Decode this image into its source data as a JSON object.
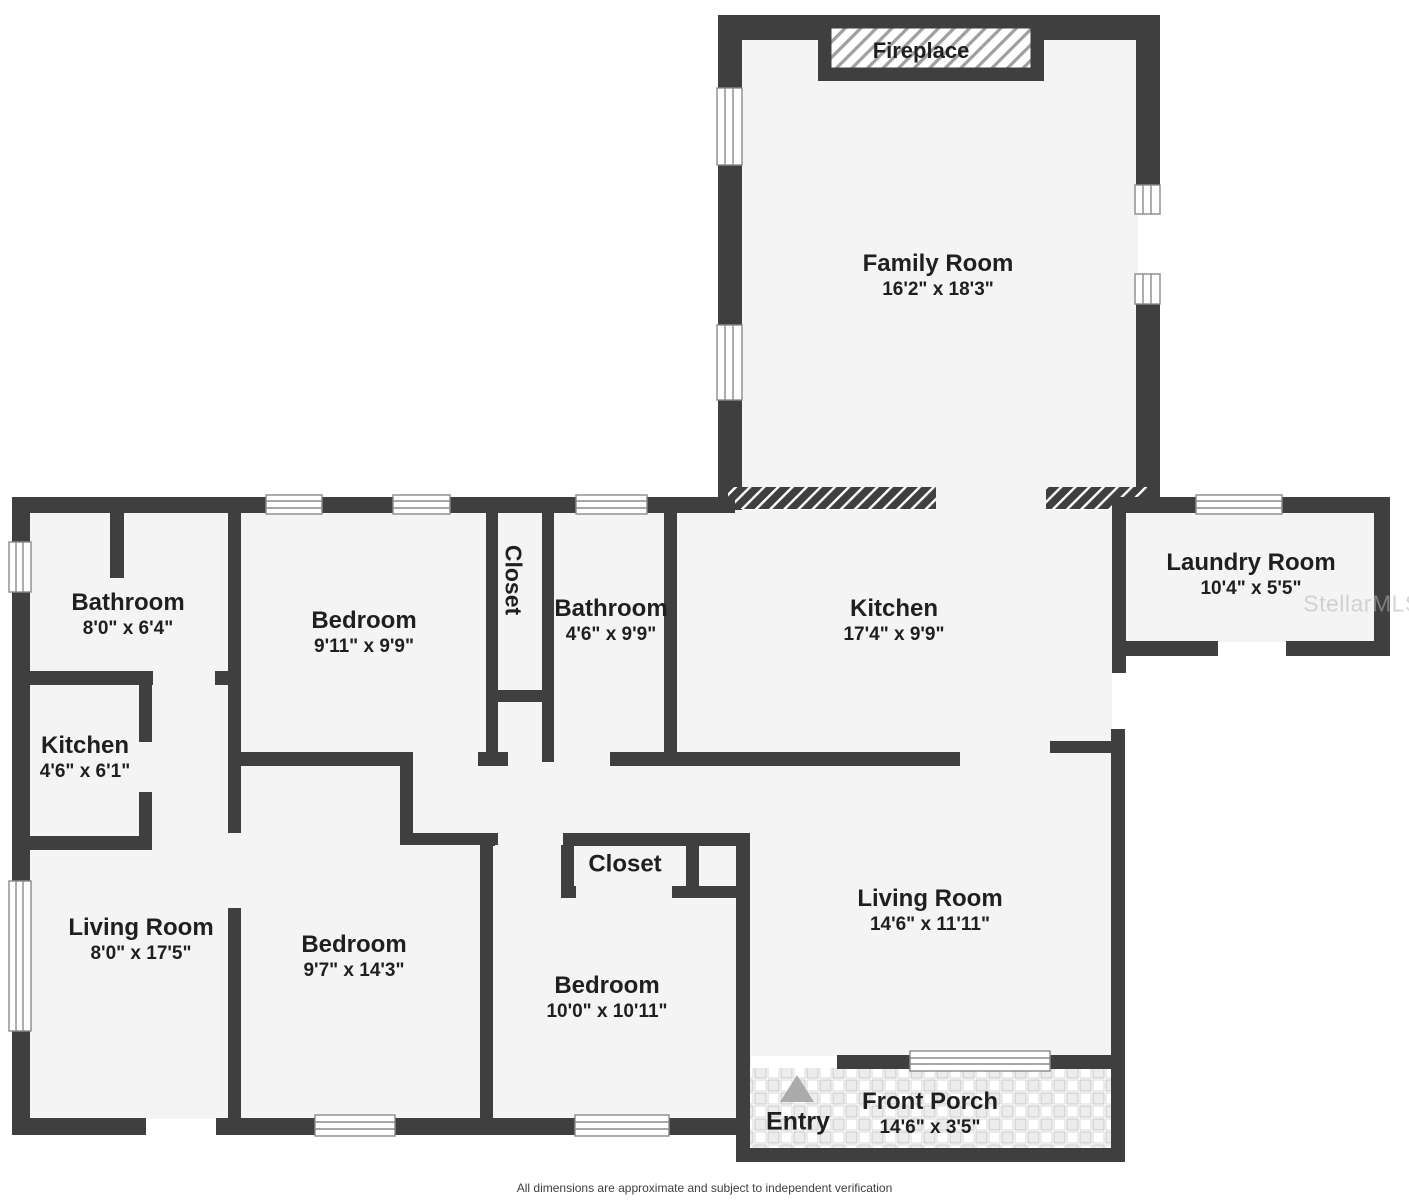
{
  "plan": {
    "footer": "All dimensions are approximate and subject to independent verification",
    "watermark": "StellarMLS",
    "labels": {
      "fireplace": "Fireplace",
      "entry": "Entry"
    },
    "colors": {
      "wall": "#3f3f3f",
      "floor": "#f4f4f4",
      "background": "#ffffff",
      "fireplace_hatch_line": "#9f9f9f",
      "porch_tile": "#ececec",
      "entry_arrow": "#ababab",
      "label_text": "#1f1f1f",
      "footer_text": "#3f3f3f",
      "watermark_text": "#b5b5b5"
    }
  },
  "rooms": [
    {
      "id": "family-room",
      "name": "Family Room",
      "dims": "16'2\" x 18'3\""
    },
    {
      "id": "laundry-room",
      "name": "Laundry Room",
      "dims": "10'4\" x 5'5\""
    },
    {
      "id": "kitchen-main",
      "name": "Kitchen",
      "dims": "17'4\" x 9'9\""
    },
    {
      "id": "bathroom-hall",
      "name": "Bathroom",
      "dims": "4'6\" x 9'9\""
    },
    {
      "id": "closet-hall",
      "name": "Closet",
      "dims": ""
    },
    {
      "id": "bedroom-middle",
      "name": "Bedroom",
      "dims": "9'11\" x 9'9\""
    },
    {
      "id": "bathroom-left",
      "name": "Bathroom",
      "dims": "8'0\" x 6'4\""
    },
    {
      "id": "kitchen-small",
      "name": "Kitchen",
      "dims": "4'6\" x 6'1\""
    },
    {
      "id": "living-room-left",
      "name": "Living Room",
      "dims": "8'0\" x 17'5\""
    },
    {
      "id": "bedroom-lower-left",
      "name": "Bedroom",
      "dims": "9'7\" x 14'3\""
    },
    {
      "id": "bedroom-lower-mid",
      "name": "Bedroom",
      "dims": "10'0\" x 10'11\""
    },
    {
      "id": "closet-lower",
      "name": "Closet",
      "dims": ""
    },
    {
      "id": "living-room-right",
      "name": "Living Room",
      "dims": "14'6\" x 11'11\""
    },
    {
      "id": "front-porch",
      "name": "Front Porch",
      "dims": "14'6\" x 3'5\""
    }
  ]
}
